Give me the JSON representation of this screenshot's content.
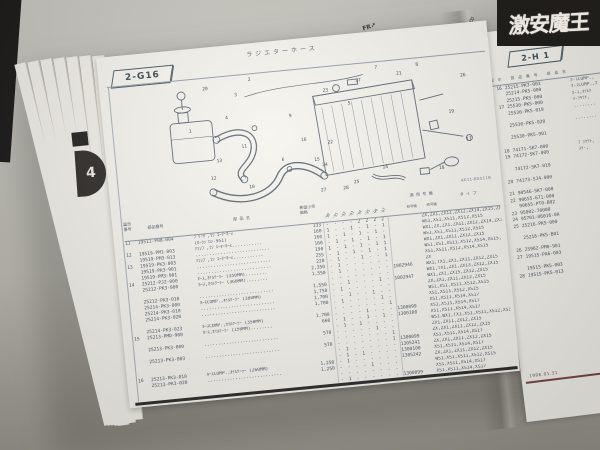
{
  "watermark": {
    "text": "激安魔王"
  },
  "left_page": {
    "section_label": "2-G16",
    "page_title": "ラジエターホース",
    "fr_marker": "FR↗",
    "corner_label": "B-5",
    "tab_number": "4",
    "diagram_code": "AK11-B0511B",
    "callouts": [
      {
        "n": "20",
        "x": 25,
        "y": 7
      },
      {
        "n": "2",
        "x": 37,
        "y": 3
      },
      {
        "n": "23",
        "x": 57,
        "y": 17
      },
      {
        "n": "27",
        "x": 66,
        "y": 11
      },
      {
        "n": "7",
        "x": 71,
        "y": 3
      },
      {
        "n": "8",
        "x": 82,
        "y": 4
      },
      {
        "n": "21",
        "x": 77,
        "y": 9
      },
      {
        "n": "26",
        "x": 94,
        "y": 15
      },
      {
        "n": "1",
        "x": 20,
        "y": 38
      },
      {
        "n": "3",
        "x": 33,
        "y": 14
      },
      {
        "n": "4",
        "x": 30,
        "y": 30
      },
      {
        "n": "9",
        "x": 47,
        "y": 33
      },
      {
        "n": "5",
        "x": 63,
        "y": 28
      },
      {
        "n": "16",
        "x": 50,
        "y": 52
      },
      {
        "n": "22",
        "x": 57,
        "y": 56
      },
      {
        "n": "11",
        "x": 34,
        "y": 53
      },
      {
        "n": "13",
        "x": 27,
        "y": 62
      },
      {
        "n": "12",
        "x": 25,
        "y": 75
      },
      {
        "n": "10",
        "x": 35,
        "y": 84
      },
      {
        "n": "6",
        "x": 44,
        "y": 66
      },
      {
        "n": "15",
        "x": 53,
        "y": 68
      },
      {
        "n": "24",
        "x": 55,
        "y": 73
      },
      {
        "n": "27",
        "x": 54,
        "y": 92
      },
      {
        "n": "28",
        "x": 60,
        "y": 92
      },
      {
        "n": "25",
        "x": 63,
        "y": 88
      },
      {
        "n": "14",
        "x": 71,
        "y": 79
      },
      {
        "n": "18",
        "x": 86,
        "y": 83
      },
      {
        "n": "19",
        "x": 90,
        "y": 42
      },
      {
        "n": "17",
        "x": 94,
        "y": 64
      }
    ],
    "table": {
      "headers": {
        "ref": "図示\n番号",
        "part": "部品番号",
        "name": "部  品  名",
        "price": "希望小売\n価格",
        "serial": "適 用 号 機",
        "serial_start": "初号機",
        "serial_end": "終号機",
        "type": "タ  イ  プ"
      },
      "year_codes": [
        "'90",
        "'91",
        "'92",
        "'93",
        "'94",
        "'95",
        "'96",
        "'97"
      ],
      "rows": [
        {
          "ref": "11",
          "part": "19511-P08-004",
          "name": "ﾌﾟﾘｰｻﾞ,ﾗｼﾞｴｰﾀｰﾎｰｽ",
          "price": "133",
          "qty": "- - - - 2 2 2 2",
          "serial": "",
          "models": "ZX,ZX1,ZX11,ZX12,ZX14,ZX15,ZX17"
        },
        {
          "ref": "",
          "part": "",
          "name": "  (ｶｰﾗｼﾞﾛﾝ-951)",
          "price": "160",
          "qty": "1 - - 1 - 1 - 1",
          "serial": "",
          "models": "WS1,XS1,XS11,XS12,XS15"
        },
        {
          "ref": "12",
          "part": "19519-PM1-003",
          "name": "ｸﾗﾝﾌﾟ,ﾗｼﾞｴｰﾀｰﾎｰｽ...........",
          "price": "160",
          "qty": "1 - 1 - 1 - 1 -",
          "serial": "",
          "models": "WX1,ZX,ZX1,ZX11,ZX12,ZX14,ZX15"
        },
        {
          "ref": "",
          "part": "19519-PM3-013",
          "name": "...........................",
          "price": "160",
          "qty": "- 1 - 1 - 1 - 1",
          "serial": "",
          "models": "WS1,XS1,XS11,XS12,XS15"
        },
        {
          "ref": "13",
          "part": "19519-PK3-003",
          "name": "ｸﾗﾝﾌﾟ,ﾗｼﾞｴｰﾀｰﾎｰｽ...........",
          "price": "190",
          "qty": "1 - 1 - 1 - 1 1",
          "serial": "",
          "models": "WX1,ZX1,ZX11,ZX12,ZX15"
        },
        {
          "ref": "",
          "part": "19519-PK3-901",
          "name": "...........................",
          "price": "255",
          "qty": "- 1 - 1 - 1 - 1",
          "serial": "",
          "models": "WS1,XS1,XS11,XS12,XS14,XS15,"
        },
        {
          "ref": "",
          "part": "19519-PM3-901",
          "name": "...........................",
          "price": "220",
          "qty": "- 1 - - 1 - - 1",
          "serial": "",
          "models": "XS1,XS11,XS12,XS14,XS15"
        },
        {
          "ref": "14",
          "part": "25212-PJ2-000",
          "name": "ﾎｰｽ,ｵｲﾙｸｰﾗｰ (350MM)........",
          "price": "2,350",
          "qty": "- 1 - - - - - -",
          "serial": "",
          "models": "ZX"
        },
        {
          "ref": "",
          "part": "25212-PK3-000",
          "name": "ﾎｰｽ,ｵｲﾙｸｰﾗｰ (360MM)........",
          "price": "1,550",
          "qty": "- 1 - - - - - -",
          "serial": "1002946",
          "models": "WX1,TX1,ZX1,ZX11,ZX12,ZX15"
        },
        {
          "ref": "",
          "part": "",
          "name": "",
          "price": "",
          "qty": "- - - - - - - -",
          "serial": "",
          "models": "WX1,TX1,ZX1,ZX13,ZX12,ZX15"
        },
        {
          "ref": "",
          "part": "25212-PK3-010",
          "name": "...........................",
          "price": "1,550",
          "qty": "- - 1 - - - 1 -",
          "serial": "1002947",
          "models": "WX1,ZX1,ZX15,ZX12,ZX15"
        },
        {
          "ref": "",
          "part": "25214-PK3-000",
          "name": "ﾎｰｽCOMP.,ｵｲﾙｸｰﾗｰ (380MM)",
          "price": "1,750",
          "qty": "- 1 - - - - - -",
          "serial": "",
          "models": "ZX,ZX1,ZX11,ZX12,ZX15"
        },
        {
          "ref": "",
          "part": "25214-PK3-010",
          "name": "...........................",
          "price": "1,700",
          "qty": "- - 1 - - 1 - -",
          "serial": "",
          "models": "WS1,XS1,XS11,XS12,XS15"
        },
        {
          "ref": "",
          "part": "25214-PK3-020",
          "name": "...........................",
          "price": "1,700",
          "qty": "- 1 - - - - 1 -",
          "serial": "",
          "models": "XS1,XS11,XS12,XS15"
        },
        {
          "ref": "",
          "part": "",
          "name": "",
          "price": "",
          "qty": "- - - - - - - 1",
          "serial": "",
          "models": "XS1,XS11,XS14,XS17"
        },
        {
          "ref": "",
          "part": "25214-PK3-023",
          "name": "ﾎｰｽCOMP.,ｵｲﾙｸｰﾗｰ (350MM)",
          "price": "1,700",
          "qty": "- - - - 1 - - -",
          "serial": "1300099",
          "models": "XS1,XS11,XS14,XS17"
        },
        {
          "ref": "15",
          "part": "25213-PMD-900",
          "name": "ﾎｰｽ,ｵｲﾙｸｰﾗｰ (150MM)........",
          "price": "660",
          "qty": "- 1 - - 1 - 1 -",
          "serial": "1300100",
          "models": "XS1,XS11,XS14,XS17"
        },
        {
          "ref": "",
          "part": "",
          "name": "",
          "price": "",
          "qty": "- 1 - 1 - - - -",
          "serial": "",
          "models": "WS1,WX1,TX1,XS1,XS11,XS12,XS15"
        },
        {
          "ref": "",
          "part": "25213-PK3-000",
          "name": "...........................",
          "price": "570",
          "qty": "- - - - - 1 - -",
          "serial": "",
          "models": "ZX1,ZX11,ZX12,ZX15"
        },
        {
          "ref": "",
          "part": "",
          "name": "",
          "price": "",
          "qty": "- - - - - - - 1",
          "serial": "",
          "models": "ZX,ZX1,ZX11,ZX12,ZX15"
        },
        {
          "ref": "",
          "part": "25213-PK3-003",
          "name": "...........................",
          "price": "570",
          "qty": "- - - - - - - 1",
          "serial": "1300099",
          "models": "XS1,XS11,XS14,XS17"
        },
        {
          "ref": "",
          "part": "",
          "name": "",
          "price": "",
          "qty": "- 1 - - - - - -",
          "serial": "1305241",
          "models": "ZX,ZX1,ZX11,ZX12,ZX15"
        },
        {
          "ref": "",
          "part": "",
          "name": "",
          "price": "",
          "qty": "- 1 - 1 - - - -",
          "serial": "1300100",
          "models": "XS1,XS11,XS14,XS17"
        },
        {
          "ref": "16",
          "part": "25213-PK3-010",
          "name": "ﾎｰｽCOMP.,ｵｲﾙｸｰﾗｰ (260MM)",
          "price": "1,250",
          "qty": "- 1 - - - - - -",
          "serial": "1305242",
          "models": "ZX,ZX1,ZX11,ZX12,ZX15"
        },
        {
          "ref": "",
          "part": "25213-PK3-020",
          "name": "...........................",
          "price": "1,250",
          "qty": "- - - - 1 - - -",
          "serial": "",
          "models": "WS1,XS1,XS11,XS12,XS15"
        },
        {
          "ref": "",
          "part": "",
          "name": "",
          "price": "",
          "qty": "- - - - - - - -",
          "serial": "",
          "models": "XS1,XS11,XS14,XS17"
        },
        {
          "ref": "",
          "part": "",
          "name": "",
          "price": "",
          "qty": "- 1 - - - - - -",
          "serial": "1300099",
          "models": "XS1,XS11,XS14,XS17"
        }
      ]
    }
  },
  "right_page": {
    "section_label": "2-H 1",
    "header": "図示  部品番号  部品名",
    "date_stamp": "1996.01.31",
    "rows": [
      {
        "ref": "16",
        "part": "25215-PK3-003",
        "frag": "ﾎ-ｽCOMP.,"
      },
      {
        "ref": "",
        "part": "25214-PK5-000",
        "frag": "ﾎ-ｽCOMP.,ｵ"
      },
      {
        "ref": "",
        "part": "25215-PK5-000",
        "frag": "ﾎ-ｽ,ｵｲﾙｸ"
      },
      {
        "ref": "17",
        "part": "25530-PK5-000",
        "frag": "ﾊ-ﾂｷﾂﾄ,"
      },
      {
        "ref": "",
        "part": "25530-PK5-010",
        "frag": "........"
      },
      {
        "ref": "",
        "part": "25530-PK5-020",
        "frag": "........",
        "gap": true
      },
      {
        "ref": "",
        "part": "25530-PK5-901",
        "frag": "",
        "gap": true
      },
      {
        "ref": "18",
        "part": "74171-SK7-000",
        "frag": "ﾌﾞﾗｹﾂﾄ,",
        "gap": true
      },
      {
        "ref": "19",
        "part": "74172-SK7-000",
        "frag": "ｽﾃ-,"
      },
      {
        "ref": "",
        "part": "74172-SK7-010",
        "frag": "",
        "gap": true
      },
      {
        "ref": "20",
        "part": "74173-SJ4-000",
        "frag": "",
        "gap": true
      },
      {
        "ref": "21",
        "part": "90546-SK7-000",
        "frag": "",
        "gap": true
      },
      {
        "ref": "22",
        "part": "90655-671-000",
        "frag": ""
      },
      {
        "ref": "",
        "part": "90655-PT0-B02",
        "frag": ""
      },
      {
        "ref": "23",
        "part": "95002-70000",
        "frag": ""
      },
      {
        "ref": "24",
        "part": "95701-06016-0A",
        "frag": ""
      },
      {
        "ref": "25",
        "part": "25216-PK5-000",
        "frag": ""
      },
      {
        "ref": "",
        "part": "25216-PK5-B01",
        "frag": "",
        "gap": true
      },
      {
        "ref": "26",
        "part": "25962-PM0-901",
        "frag": "",
        "gap": true
      },
      {
        "ref": "27",
        "part": "19515-PA6-003",
        "frag": ""
      },
      {
        "ref": "",
        "part": "19515-PK5-003",
        "frag": "",
        "gap": true
      },
      {
        "ref": "28",
        "part": "19515-PK5-013",
        "frag": ""
      }
    ]
  }
}
